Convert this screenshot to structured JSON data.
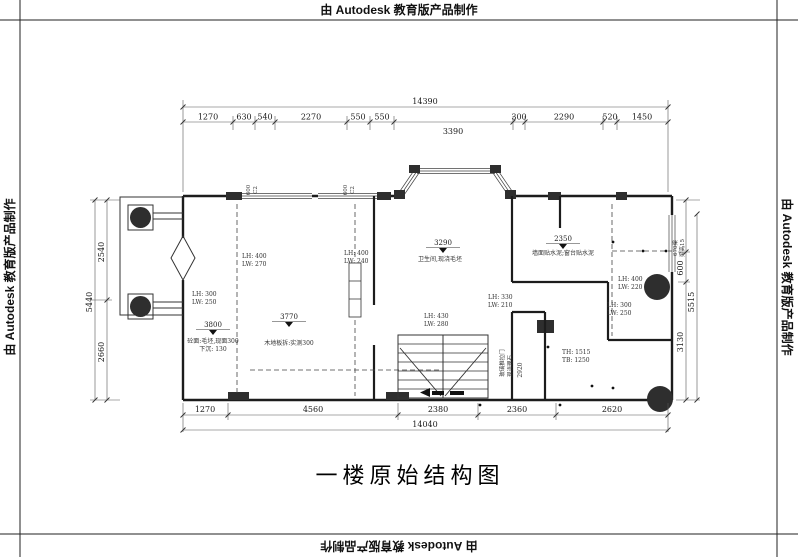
{
  "watermark_text": "由 Autodesk 教育版产品制作",
  "title": "一楼原始结构图",
  "dims": {
    "top": {
      "total": "14390",
      "mid": "3390",
      "s0": "1270",
      "s1": "630",
      "s2": "540",
      "s3": "2270",
      "s4": "550",
      "s5": "550",
      "s6": "300",
      "s7": "2290",
      "s8": "520",
      "s9": "1450"
    },
    "bottom": {
      "total": "14040",
      "s0": "1270",
      "s1": "4560",
      "s2": "2380",
      "s3": "2360",
      "s4": "2620"
    },
    "left": {
      "total": "5440",
      "s0": "2540",
      "s1": "2660"
    },
    "right": {
      "total": "5515",
      "s0": "600",
      "s1": "3130",
      "note1": "670梁",
      "note2": "梁高15"
    }
  },
  "beams": {
    "b1a": "LH: 400",
    "b1b": "LW: 270",
    "b2a": "LH: 300",
    "b2b": "LW: 250",
    "b3a": "LH: 400",
    "b3b": "LW: 240",
    "b4a": "LH: 330",
    "b4b": "LW: 210",
    "b5a": "LH: 400",
    "b5b": "LW: 220",
    "b6a": "LH: 300",
    "b6b": "LW: 250",
    "b7a": "LH: 430",
    "b7b": "LW: 280",
    "b8a": "TH: 1515",
    "b8b": "TB: 1250"
  },
  "elev": {
    "e1": "3800",
    "e1n1": "砼面:毛坯,现面300",
    "e1n2": "下沉: 130",
    "e2": "3770",
    "e2n1": "木地板拆:实测300",
    "e3": "3290",
    "e3n1": "卫生间,现浇毛坯",
    "e4": "2350",
    "e4n1": "墙面贴水泥;窗台贴水泥",
    "e5": "2920"
  },
  "notes": {
    "v0": "玻璃推拉门",
    "v1": "现浇理石",
    "wt_a": "600",
    "wt_b": "C2"
  }
}
